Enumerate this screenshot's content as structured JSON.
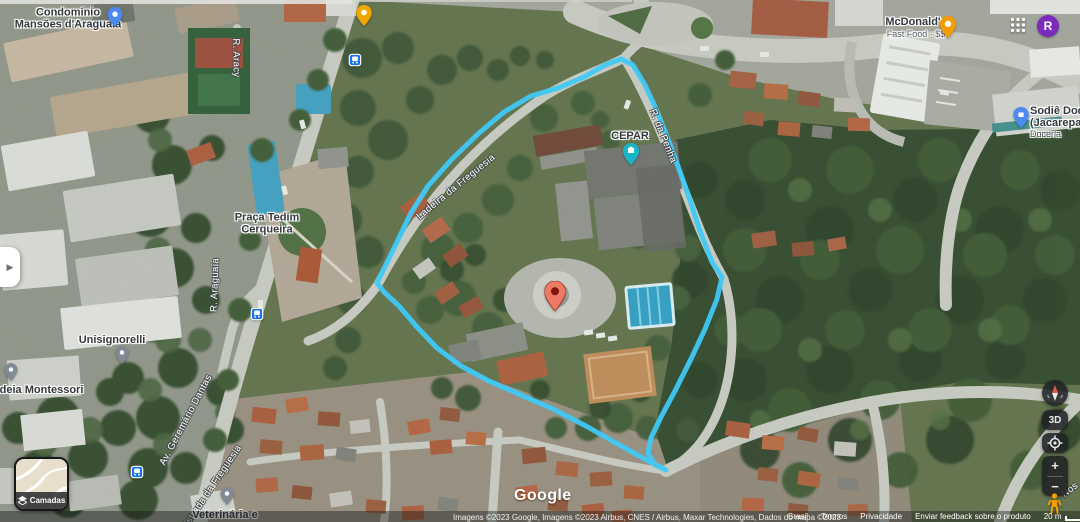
{
  "labels": {
    "condominio": {
      "line1": "Condomínio",
      "line2": "Mansões d'Araguaia"
    },
    "praca": {
      "line1": "Praça Tedim",
      "line2": "Cerqueira"
    },
    "unisignorelli": "Unisignorelli",
    "ideia": "Ideia Montessori",
    "veterinaria": "Veterinária e",
    "cepar": "CEPAR",
    "mcdonalds": {
      "name": "McDonald's",
      "sub": "Fast Food · $$"
    },
    "sodie": {
      "line1": "Sodiê Doce",
      "line2": "(Jacarepagu",
      "sub": "Doceria"
    }
  },
  "roads": {
    "aracy": "R. Aracy",
    "araguaia": "R. Araguaia",
    "geremario": "Av. Geremário Dantas",
    "estrada_freguesia": "Estrada da Freguesia",
    "ladeira_freguesia": "Ladeira da Freguesia",
    "penha": "R. da Penha",
    "nos": "Nos"
  },
  "controls": {
    "layers": "Camadas",
    "threed": "3D",
    "zoom_in": "+",
    "zoom_out": "−"
  },
  "account": {
    "avatar": "R"
  },
  "watermark": {
    "google": "Google"
  },
  "attribution": {
    "imagery": "Imagens ©2023 Google, Imagens ©2023 Airbus, CNES / Airbus, Maxar Technologies, Dados do mapa ©2023",
    "links": [
      "Brasil",
      "Termos",
      "Privacidade",
      "Enviar feedback sobre o produto"
    ],
    "scale": "20 m"
  },
  "icons": {
    "collapse_panel": "▶",
    "apps_grid": "3x3-dots",
    "layers": "diamond-stack",
    "compass": "red-needle",
    "my_location": "target",
    "pegman": "orange-person"
  },
  "colors": {
    "polygon": "#3fc9f7",
    "marker_fill": "#ee7a66",
    "marker_dot": "#7c150c",
    "cepar_pin": "#18b6c9",
    "mcdonalds_pin": "#f59b00",
    "restaurant_pin": "#f0a800",
    "place_pin_blue": "#4d8af0",
    "generic_pin_gray": "#7f8a93",
    "bus_icon_blue": "#1a73e8",
    "avatar_bg": "#7c2bbd"
  }
}
